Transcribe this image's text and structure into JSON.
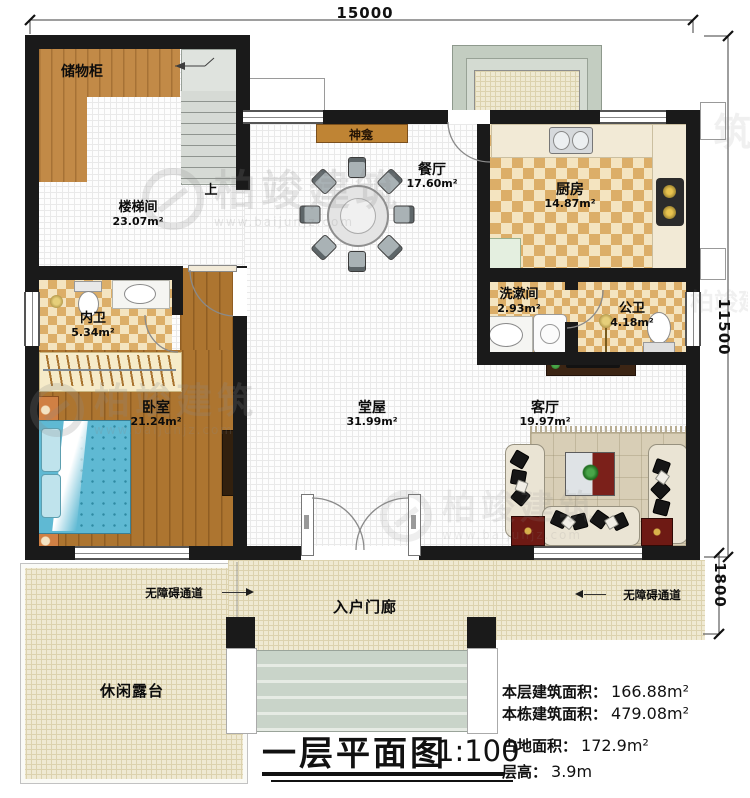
{
  "watermark": {
    "brand": "柏竣建筑",
    "url": "www.baijunjz.com"
  },
  "dimensions": {
    "top": "15000",
    "right": "11500",
    "porch_depth": "1800"
  },
  "rooms": {
    "storage": {
      "name": "储物柜"
    },
    "stairwell": {
      "name": "楼梯间",
      "area": "23.07m²"
    },
    "shrine": {
      "name": "神龛"
    },
    "dining": {
      "name": "餐厅",
      "area": "17.60m²"
    },
    "kitchen": {
      "name": "厨房",
      "area": "14.87m²"
    },
    "inner_bath": {
      "name": "内卫",
      "area": "5.34m²"
    },
    "washroom": {
      "name": "洗漱间",
      "area": "2.93m²"
    },
    "public_bath": {
      "name": "公卫",
      "area": "4.18m²"
    },
    "bedroom": {
      "name": "卧室",
      "area": "21.24m²"
    },
    "hall": {
      "name": "堂屋",
      "area": "31.99m²"
    },
    "living": {
      "name": "客厅",
      "area": "19.97m²"
    },
    "entry_porch": {
      "name": "入户门廊"
    },
    "terrace": {
      "name": "休闲露台"
    }
  },
  "annotations": {
    "stairs_up": "上",
    "accessible_left": "无障碍通道",
    "accessible_right": "无障碍通道"
  },
  "title_block": {
    "title": "一层平面图",
    "scale": "1:100",
    "stats": [
      {
        "label": "本层建筑面积：",
        "value": "166.88m²"
      },
      {
        "label": "本栋建筑面积：",
        "value": "479.08m²"
      },
      {
        "label": "占地面积：",
        "value": "172.9m²"
      },
      {
        "label": "层高：",
        "value": "3.9m"
      }
    ]
  },
  "colors": {
    "wall": "#1a1a1a",
    "wood_floor": "#ad7530",
    "cabinet_wood": "#c28a47",
    "checker_dark": "#dcae68",
    "checker_light": "#f4e4c0",
    "bed_blue": "#5fb9d3",
    "terrace_cream": "#efe9d2",
    "accent_red": "#6e1a14"
  }
}
